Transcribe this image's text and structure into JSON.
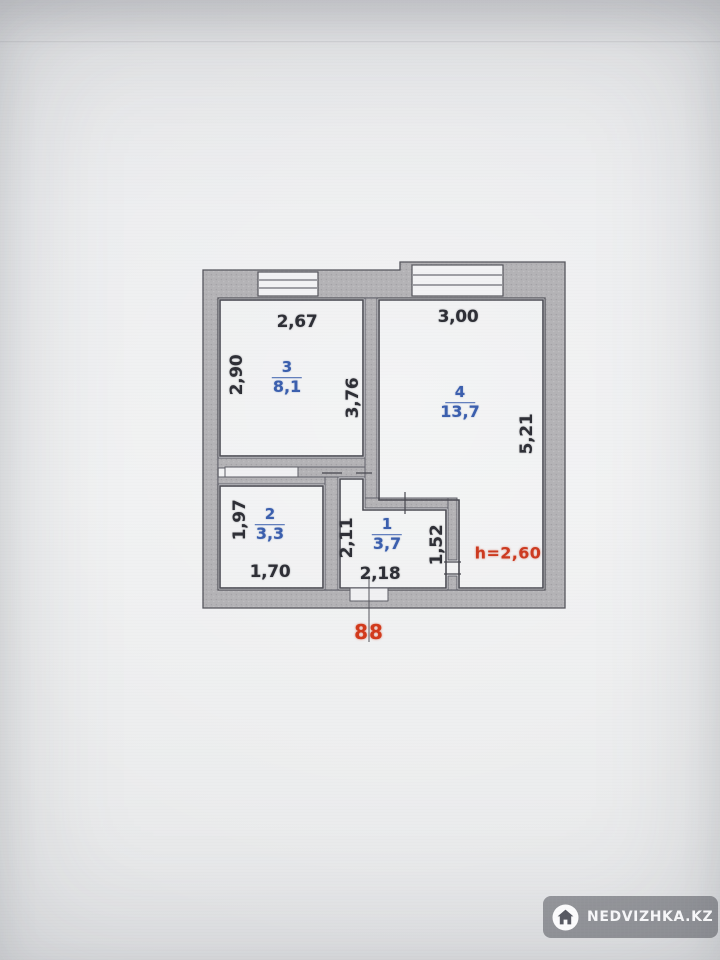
{
  "plan": {
    "rooms": [
      {
        "number": "1",
        "area": "3,7"
      },
      {
        "number": "2",
        "area": "3,3"
      },
      {
        "number": "3",
        "area": "8,1"
      },
      {
        "number": "4",
        "area": "13,7"
      }
    ],
    "dimensions": {
      "top_left": "2,67",
      "top_right": "3,00",
      "left_upper": "2,90",
      "center_vertical": "3,76",
      "right_side": "5,21",
      "left_lower": "1,97",
      "hall_left": "2,11",
      "hall_right": "1,52",
      "bottom_left": "1,70",
      "bottom_center": "2,18"
    },
    "annotations": {
      "ceiling_height": "h=2,60",
      "unit_number": "88"
    },
    "colors": {
      "room_label_blue": "#3b5fae",
      "dimension_text": "#2e2f36",
      "annotation_red": "#cd3a20",
      "wall_fill": "#b4b3b6"
    }
  },
  "watermark": {
    "text": "NEDVIZHKA.KZ",
    "icon": "house-icon"
  }
}
